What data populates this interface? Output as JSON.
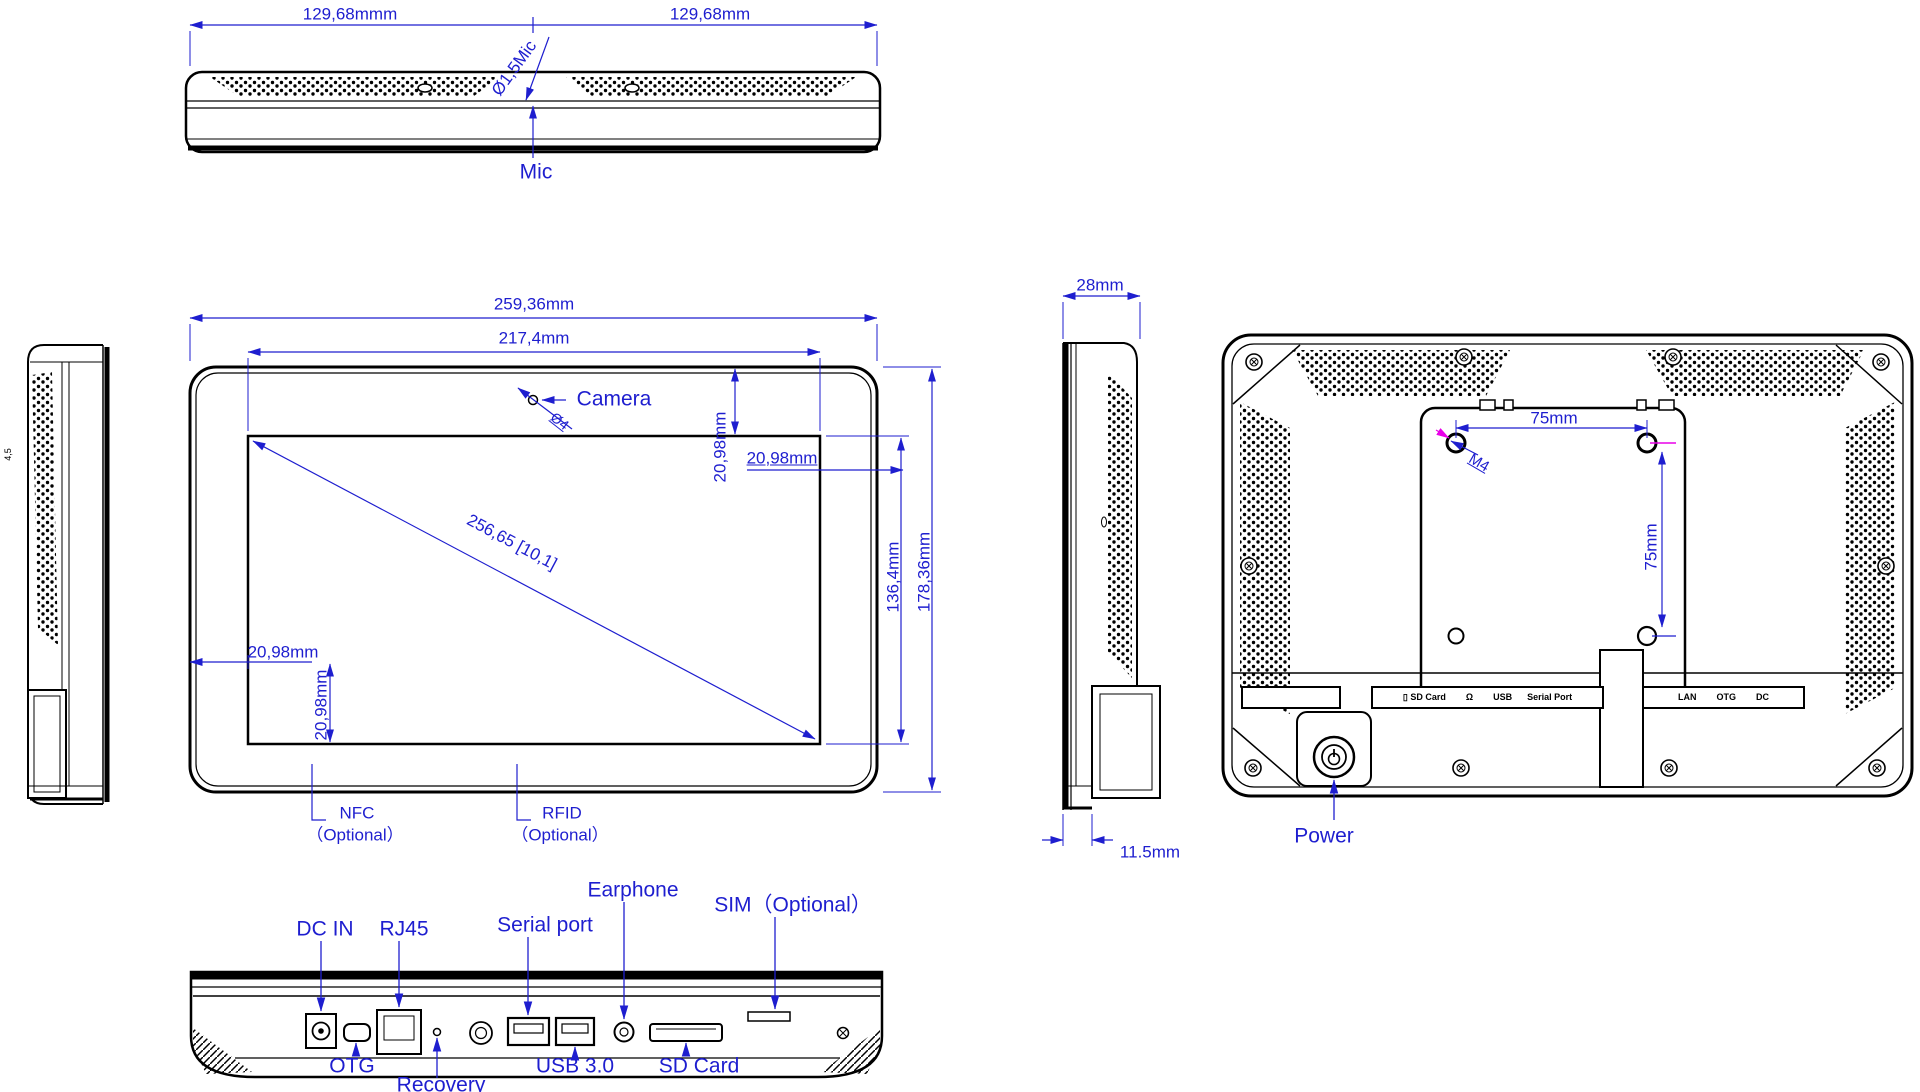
{
  "colors": {
    "dimension_blue": "#1e1ecf",
    "accent_magenta": "#e800e8",
    "line_black": "#000000"
  },
  "views": {
    "top": {
      "dim_left": "129,68mmm",
      "dim_right": "129,68mm",
      "mic_diameter": "Ø1,5Mic",
      "mic": "Mic"
    },
    "left_side": {
      "tiny_mark": "4,5"
    },
    "front": {
      "width_outer": "259,36mm",
      "width_screen": "217,4mm",
      "camera": "Camera",
      "camera_diameter": "Ø4",
      "margin_top_right": "20,98mm",
      "margin_right": "20,98mm",
      "screen_height": "136,4mm",
      "height": "178,36mm",
      "diagonal": "256,65 [10,1]",
      "margin_left": "20,98mm",
      "margin_bottom": "20,98mm",
      "nfc": "NFC",
      "nfc_optional": "（Optional）",
      "rfid": "RFID",
      "rfid_optional": "（Optional）"
    },
    "side": {
      "depth": "28mm",
      "stand_depth": "11.5mm"
    },
    "back": {
      "vesa_width": "75mm",
      "vesa_height": "75mm",
      "screw": "M4",
      "power": "Power",
      "strip_left": "▯ SD Card        Ω        USB      Serial Port",
      "strip_right": "LAN        OTG        DC"
    },
    "bottom": {
      "dc_in": "DC IN",
      "rj45": "RJ45",
      "serial": "Serial port",
      "earphone": "Earphone",
      "sim": "SIM（Optional）",
      "otg": "OTG",
      "recovery": "Recovery",
      "usb": "USB 3.0",
      "sd": "SD Card"
    }
  }
}
